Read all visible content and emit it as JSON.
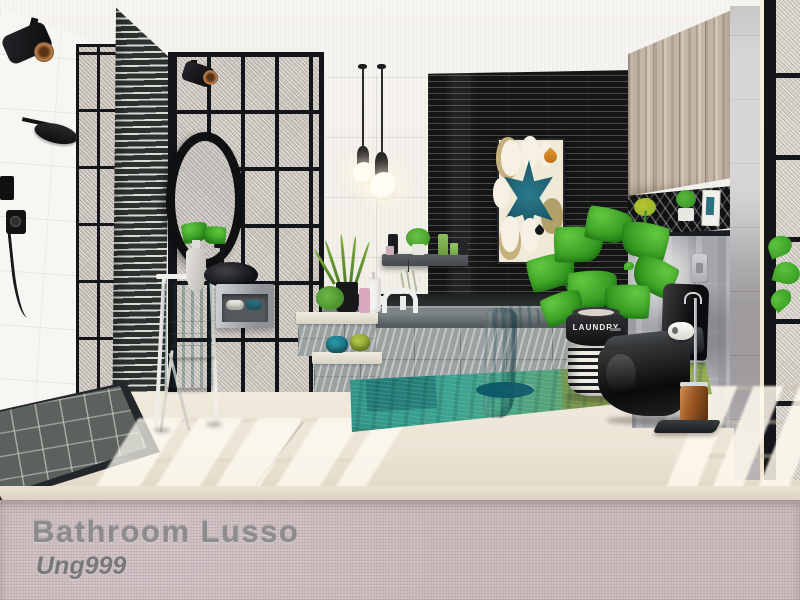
{
  "banner": {
    "title": "Bathroom Lusso",
    "author": "Ung999"
  },
  "scene": {
    "laundry_basket_label": "LAUNDRY"
  },
  "palette": {
    "banner-bg": "#c8b8ba",
    "title-color": "#8c8c8c",
    "author-color": "#787878",
    "towel-teal": "#157585",
    "towel-teal-dark": "#0d5e6e",
    "rug-teal": "#2f9487",
    "rug-olive": "#8aa04a",
    "art-teal": "#20687a",
    "art-orange": "#d2831e",
    "art-cream": "#efe9d8",
    "black-tile": "#151515",
    "marble": "#9aa1a1",
    "floor-cream": "#ece4d5",
    "wood-tan": "#c3b6a7",
    "plant-green": "#2f941d",
    "copper": "#a05a24"
  }
}
